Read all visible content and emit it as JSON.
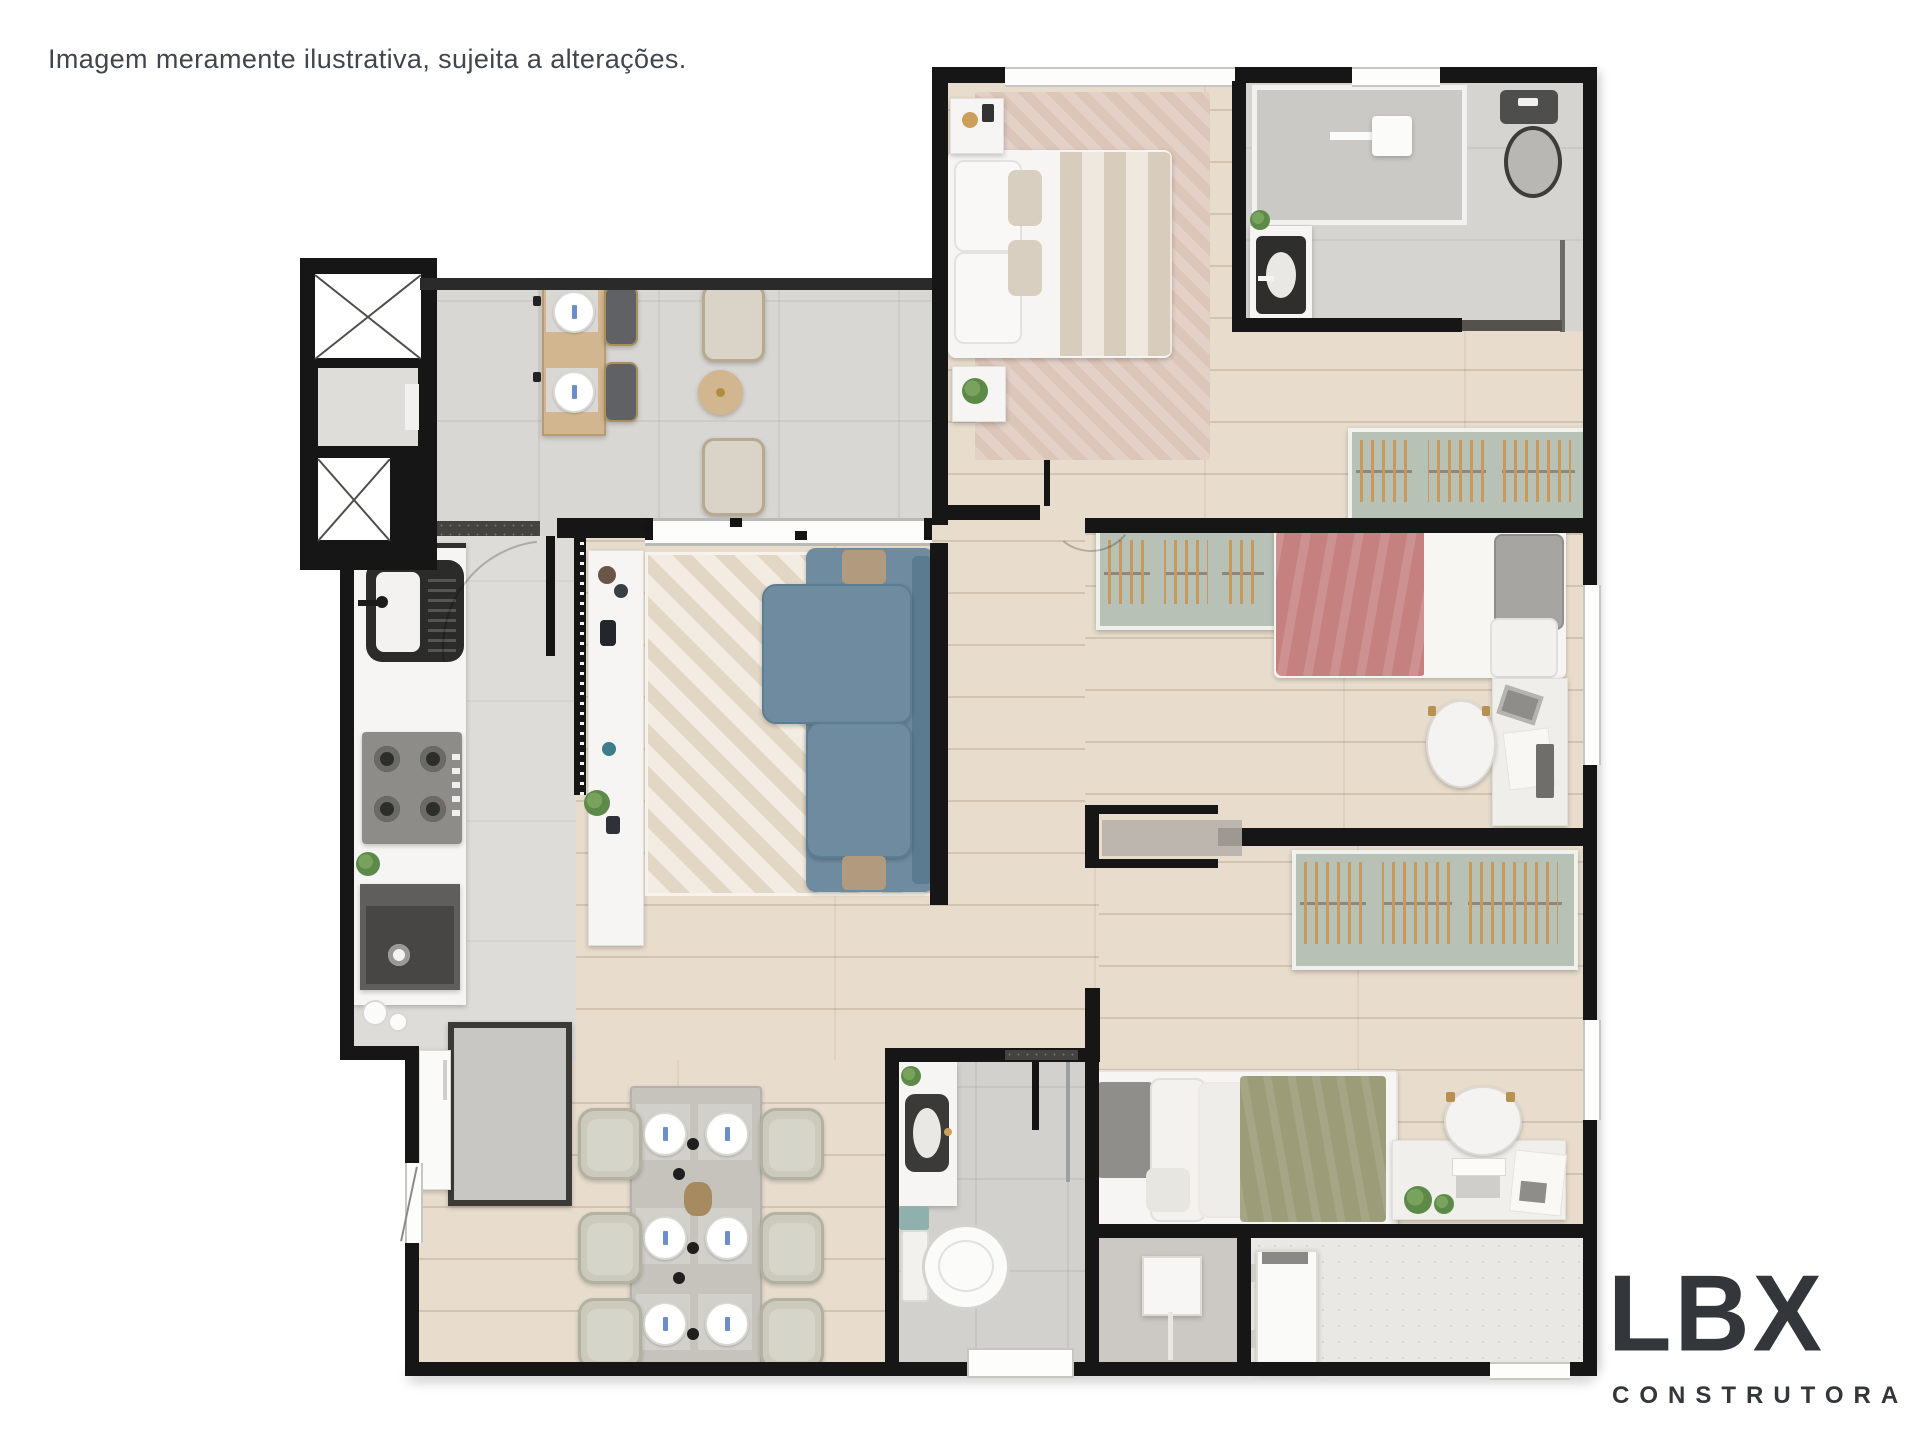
{
  "disclaimer": "Imagem meramente ilustrativa, sujeita a alterações.",
  "logo": {
    "name": "LBX",
    "subtitle": "CONSTRUTORA"
  },
  "palette": {
    "wall": "#161616",
    "wood": "#e8ddcd",
    "grayFloor": "#d9d7d3",
    "kitchenFloor": "#dedcd8",
    "bathFloor": "#d3d1cd",
    "masterBathFloor": "#d6d4d0",
    "serviceGray": "#ccc9c5",
    "serviceSpeckle": "#e9e8e5",
    "rugMaster": "#dcc5b9",
    "sofa": "#6f8ba0",
    "sofaDark": "#5b7b91",
    "sofaTan": "#b19a7e",
    "duvetPink": "#c4817f",
    "duvetGreen": "#9c9c78",
    "closetTeal": "#b7c1b6",
    "hangerWood": "#c9995c",
    "granite": "#454340",
    "furnWhite": "#f6f5f3",
    "chairSage": "#cbcabc",
    "tableGray": "#c6c3bd",
    "woodFurn": "#d2b68f",
    "chairBeige": "#d9d3c8",
    "chairDark": "#5f6165",
    "toiletDark": "#4e4e4c",
    "plantGreen": "#5e8a49",
    "logoColor": "#33373b",
    "textColor": "#41464c"
  }
}
